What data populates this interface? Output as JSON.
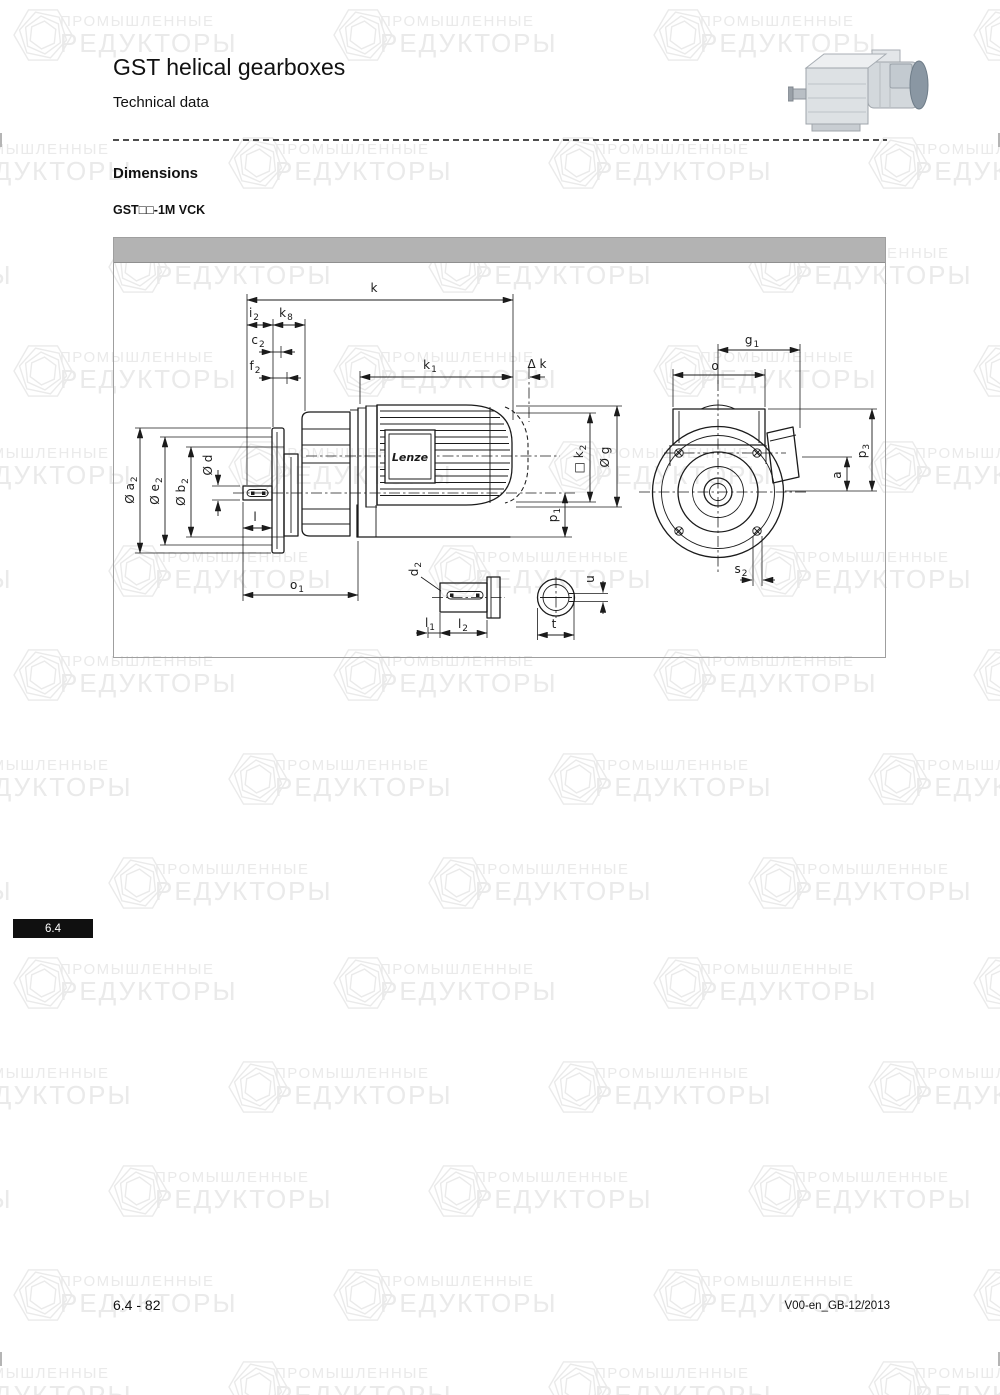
{
  "page": {
    "title": "GST helical gearboxes",
    "subtitle": "Technical data",
    "section_heading": "Dimensions",
    "variant_label": "GST□□-1M VCK",
    "tab_label": "6.4",
    "footer_left": "6.4 - 82",
    "footer_right": "V00-en_GB-12/2013"
  },
  "watermark": {
    "line1": "ПРОМЫШЛЕННЫЕ",
    "line2": "РЕДУКТОРЫ",
    "color": "#eaeaea"
  },
  "colors": {
    "drawing_bar": "#b3b3b3",
    "line": "#1b1b1b",
    "tab_bg": "#101010"
  },
  "drawing": {
    "brand_label": "Lenze",
    "labels": [
      {
        "t": "k",
        "s": "",
        "x": 374,
        "y": 292,
        "r": 0
      },
      {
        "t": "i",
        "s": "2",
        "x": 254,
        "y": 317,
        "r": 0
      },
      {
        "t": "k",
        "s": "8",
        "x": 286,
        "y": 317,
        "r": 0
      },
      {
        "t": "c",
        "s": "2",
        "x": 258,
        "y": 344,
        "r": 0
      },
      {
        "t": "f",
        "s": "2",
        "x": 255,
        "y": 370,
        "r": 0
      },
      {
        "t": "k",
        "s": "1",
        "x": 430,
        "y": 369,
        "r": 0
      },
      {
        "t": "Δ k",
        "s": "",
        "x": 537,
        "y": 368,
        "r": 0
      },
      {
        "t": "g",
        "s": "1",
        "x": 752,
        "y": 344,
        "r": 0
      },
      {
        "t": "o",
        "s": "",
        "x": 715,
        "y": 370,
        "r": 0
      },
      {
        "t": "Ø a",
        "s": "2",
        "x": 134,
        "y": 490,
        "r": -90
      },
      {
        "t": "Ø e",
        "s": "2",
        "x": 159,
        "y": 491,
        "r": -90
      },
      {
        "t": "Ø b",
        "s": "2",
        "x": 185,
        "y": 492,
        "r": -90
      },
      {
        "t": "Ø d",
        "s": "",
        "x": 212,
        "y": 465,
        "r": -90
      },
      {
        "t": "l",
        "s": "",
        "x": 255,
        "y": 521,
        "r": 0
      },
      {
        "t": "o",
        "s": "1",
        "x": 297,
        "y": 589,
        "r": 0
      },
      {
        "t": "p",
        "s": "1",
        "x": 557,
        "y": 515,
        "r": -90
      },
      {
        "t": "□ k",
        "s": "2",
        "x": 583,
        "y": 459,
        "r": -90
      },
      {
        "t": "Ø g",
        "s": "",
        "x": 609,
        "y": 457,
        "r": -90
      },
      {
        "t": "p",
        "s": "3",
        "x": 866,
        "y": 451,
        "r": -90
      },
      {
        "t": "a",
        "s": "",
        "x": 841,
        "y": 475,
        "r": -90
      },
      {
        "t": "s",
        "s": "2",
        "x": 741,
        "y": 573,
        "r": 0
      },
      {
        "t": "d",
        "s": "2",
        "x": 418,
        "y": 569,
        "r": -90
      },
      {
        "t": "l",
        "s": "1",
        "x": 430,
        "y": 627,
        "r": 0
      },
      {
        "t": "l",
        "s": "2",
        "x": 463,
        "y": 628,
        "r": 0
      },
      {
        "t": "u",
        "s": "",
        "x": 594,
        "y": 579,
        "r": -90
      },
      {
        "t": "t",
        "s": "",
        "x": 554,
        "y": 628,
        "r": 0
      }
    ]
  }
}
